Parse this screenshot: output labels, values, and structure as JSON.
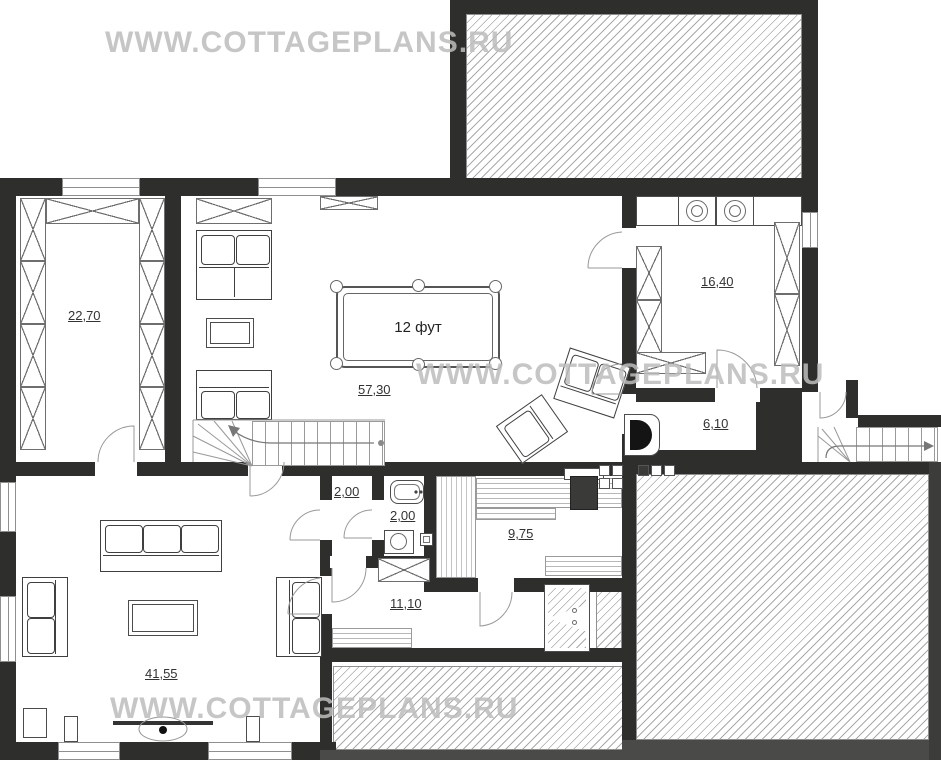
{
  "plan": {
    "watermark": "WWW.COTTAGEPLANS.RU",
    "billiard_label": "12 фут",
    "rooms": [
      {
        "name": "dressing-room",
        "area": "22,70"
      },
      {
        "name": "game-room",
        "area": "57,30"
      },
      {
        "name": "kitchen",
        "area": "16,40"
      },
      {
        "name": "hallway",
        "area": "6,10"
      },
      {
        "name": "hall",
        "area": "2,00"
      },
      {
        "name": "bathroom",
        "area": "2,00"
      },
      {
        "name": "sauna",
        "area": "9,75"
      },
      {
        "name": "washroom",
        "area": "11,10"
      },
      {
        "name": "living-room",
        "area": "41,55"
      }
    ],
    "colors": {
      "wall": "#2e2e2c",
      "terrace_border": "#4a4a49",
      "hatch_line": "#aaaaaa",
      "watermark": "#bcbcbc",
      "label_text": "#333333"
    }
  }
}
